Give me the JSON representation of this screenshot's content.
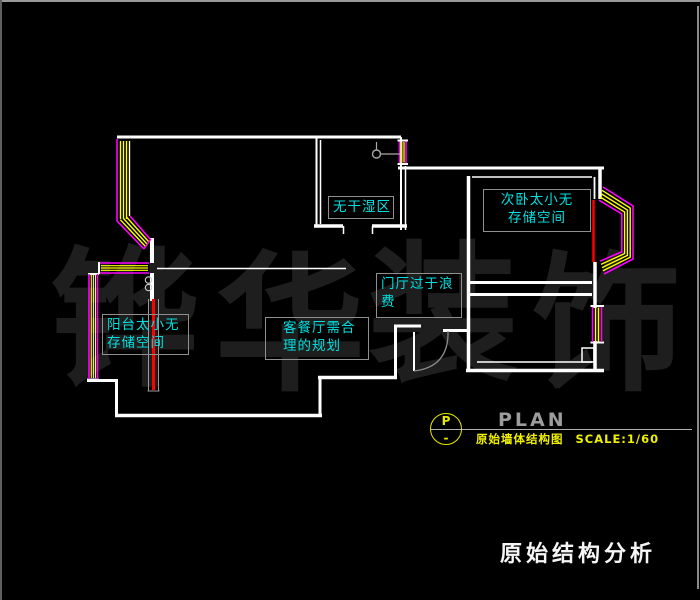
{
  "canvas": {
    "width": 700,
    "height": 600,
    "background": "#000000"
  },
  "watermark": {
    "chars": [
      "铧",
      "华",
      "装",
      "饰"
    ],
    "color": "#1e1e1e"
  },
  "annotations": {
    "bathroom": {
      "lines": [
        "无干湿区"
      ]
    },
    "bedroom": {
      "lines": [
        "次卧太小无",
        "存储空间"
      ]
    },
    "hallway": {
      "lines": [
        "门厅过于浪",
        "费"
      ]
    },
    "balcony": {
      "lines": [
        "阳台太小无",
        "存储空间"
      ]
    },
    "living": {
      "lines": [
        "客餐厅需合",
        "理的规划"
      ]
    }
  },
  "title_block": {
    "symbol_letter": "P",
    "symbol_dash": "-",
    "plan_label": "PLAN",
    "caption": "原始墙体结构图",
    "scale_label": "SCALE:1/60"
  },
  "footer": {
    "title": "原始结构分析"
  },
  "colors": {
    "wall": "#ffffff",
    "window_frame": "#ff00ff",
    "window_glass": "#ffff00",
    "highlight_red": "#ff0000",
    "annotation_text": "#00e0e0",
    "annotation_border": "#8f8f8f",
    "title_yellow": "#f0f000",
    "plan_gray": "#9c9c9c",
    "footer_white": "#f5f5f5"
  }
}
